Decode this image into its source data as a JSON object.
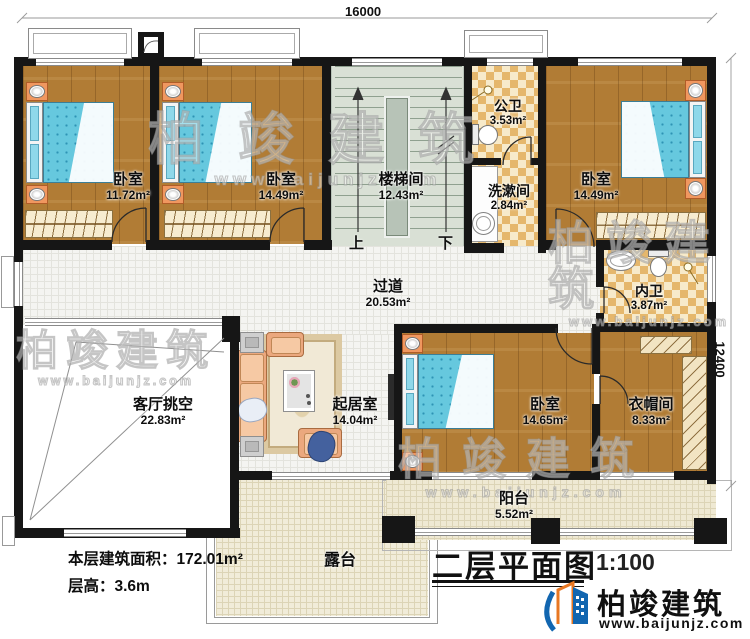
{
  "plan": {
    "title": "二层平面图",
    "scale": "1:100",
    "dims": {
      "top": "16000",
      "right": "12400"
    },
    "stats": {
      "area": "本层建筑面积：172.01m²",
      "height": "层高：3.6m"
    },
    "stairs": {
      "up": "上",
      "down": "下"
    },
    "rooms": {
      "bed1": {
        "name": "卧室",
        "area": "11.72m²"
      },
      "bed2": {
        "name": "卧室",
        "area": "14.49m²"
      },
      "stair": {
        "name": "楼梯间",
        "area": "12.43m²"
      },
      "gongwei": {
        "name": "公卫",
        "area": "3.53m²"
      },
      "xishujian": {
        "name": "洗漱间",
        "area": "2.84m²"
      },
      "bed3": {
        "name": "卧室",
        "area": "14.49m²"
      },
      "neiwei": {
        "name": "内卫",
        "area": "3.87m²"
      },
      "guodao": {
        "name": "过道",
        "area": "20.53m²"
      },
      "void": {
        "name": "客厅挑空",
        "area": "22.83m²"
      },
      "living": {
        "name": "起居室",
        "area": "14.04m²"
      },
      "bed4": {
        "name": "卧室",
        "area": "14.65m²"
      },
      "cloak": {
        "name": "衣帽间",
        "area": "8.33m²"
      },
      "balcony": {
        "name": "阳台",
        "area": "5.52m²"
      },
      "terrace": {
        "name": "露台"
      }
    },
    "brand": {
      "name": "柏竣建筑",
      "url": "www.baijunjz.com"
    },
    "watermark": {
      "name": "柏竣建筑",
      "url": "www.baijunjz.com"
    },
    "palette": {
      "wall": "#161616",
      "wood": "#b17c35",
      "tile": "#f4f4f1",
      "checker": "#e5b76c",
      "bed_blue": "#66c8de",
      "terrace": "#efe9d3",
      "accent_orange": "#e87722",
      "accent_blue": "#1266b0"
    }
  }
}
